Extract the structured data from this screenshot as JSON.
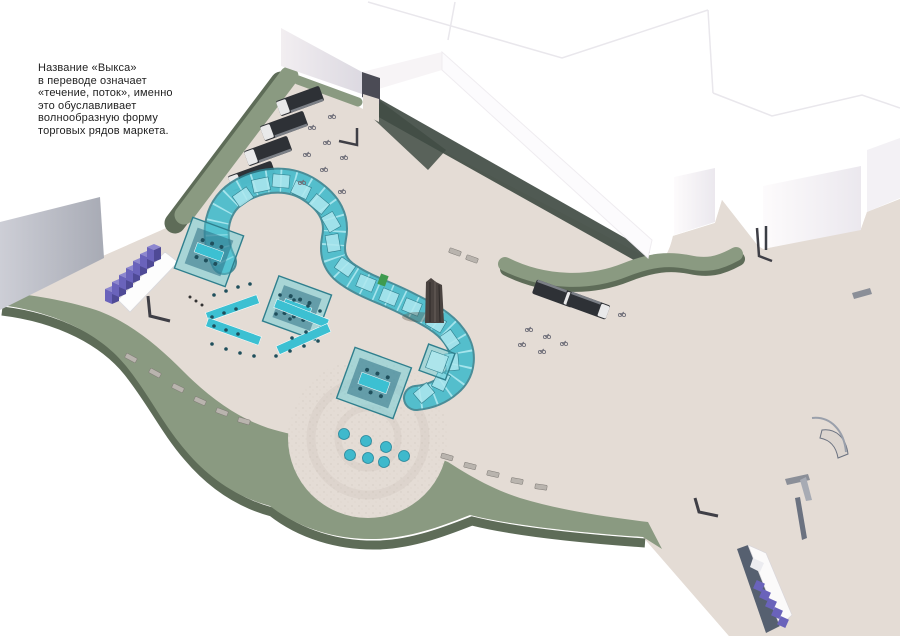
{
  "annotation": {
    "lines": [
      "Название «Выкса»",
      "в переводе означает",
      "«течение, поток», именно",
      "это обуславливает",
      "волнообразную форму",
      "торговых рядов маркета."
    ]
  },
  "palette": {
    "pavement": "#e4dcd5",
    "pavement_shade": "#d6cdc6",
    "green_top": "#8a9a81",
    "green_side": "#5e6c58",
    "green_dark": "#414c44",
    "building_face_light": "#e9e5ea",
    "building_face_gray": "#c3c4cd",
    "building_face_dark": "#a3a7b2",
    "teal_glass": "#56cbd9",
    "teal_light": "#aee8ef",
    "teal_frame": "#2f7f8d",
    "teal_table": "#3cc0d2",
    "purple": "#6a63bb",
    "purple_light": "#8d87cf",
    "purple_dark": "#4f4a96",
    "truck_body": "#2e3136",
    "wood_dark": "#4a4340",
    "bench_gray": "#b9b4ae",
    "outline_faint": "#e9e7ec",
    "text": "#1f1f1f",
    "dumpster_green": "#3f9b4f"
  },
  "scene": {
    "elements": [
      "wave-market-rows",
      "glass-pavilions",
      "picnic-chevrons",
      "parking-trucks",
      "tower-sculpture",
      "purple-modular-seating",
      "skate-ramp",
      "teal-domes",
      "benches",
      "green-landscape",
      "white-buildings",
      "circular-plaza"
    ]
  }
}
